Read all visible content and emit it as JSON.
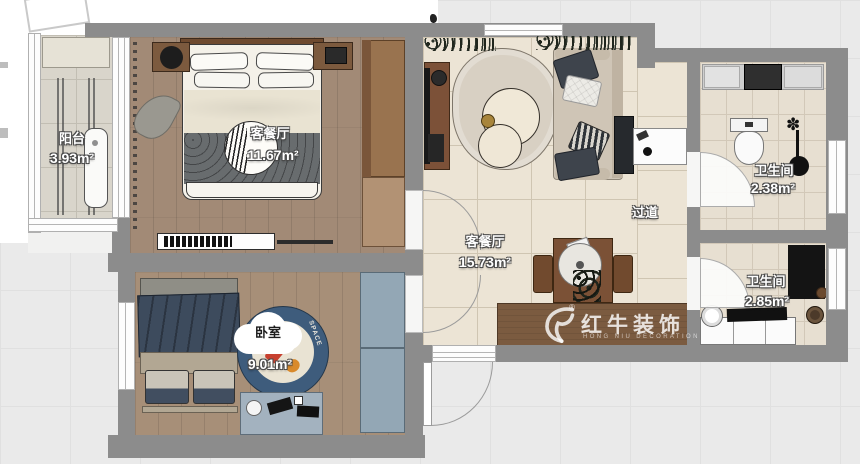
{
  "plan": {
    "rooms": [
      {
        "key": "balcony",
        "label": "阳台",
        "area": "3.93m²"
      },
      {
        "key": "master-bedroom",
        "label": "客餐厅",
        "area": "11.67m²"
      },
      {
        "key": "bedroom",
        "label": "卧室",
        "area": "9.01m²"
      },
      {
        "key": "living-dining",
        "label": "客餐厅",
        "area": "15.73m²"
      },
      {
        "key": "hallway",
        "label": "过道",
        "area": ""
      },
      {
        "key": "bathroom-upper",
        "label": "卫生间",
        "area": "2.38m²"
      },
      {
        "key": "bathroom-lower",
        "label": "卫生间",
        "area": "2.85m²"
      }
    ],
    "rug_text": "SPACE",
    "watermark": {
      "brand": "红牛装饰",
      "brand_en": "HONG NIU DECORATION",
      "registered": "®"
    },
    "colors": {
      "wall": "#8c8c8c",
      "wood_floor": "#a28a76",
      "tile_floor": "#ece4d5",
      "bath_floor": "#e7dfd1",
      "balcony_floor": "#d9d5cb",
      "furniture_wood": "#7c5a3e",
      "wardrobe_blue": "#93a7b5",
      "bed_navy": "#3d4b5d",
      "watermark_band": "#7b5b40"
    }
  }
}
